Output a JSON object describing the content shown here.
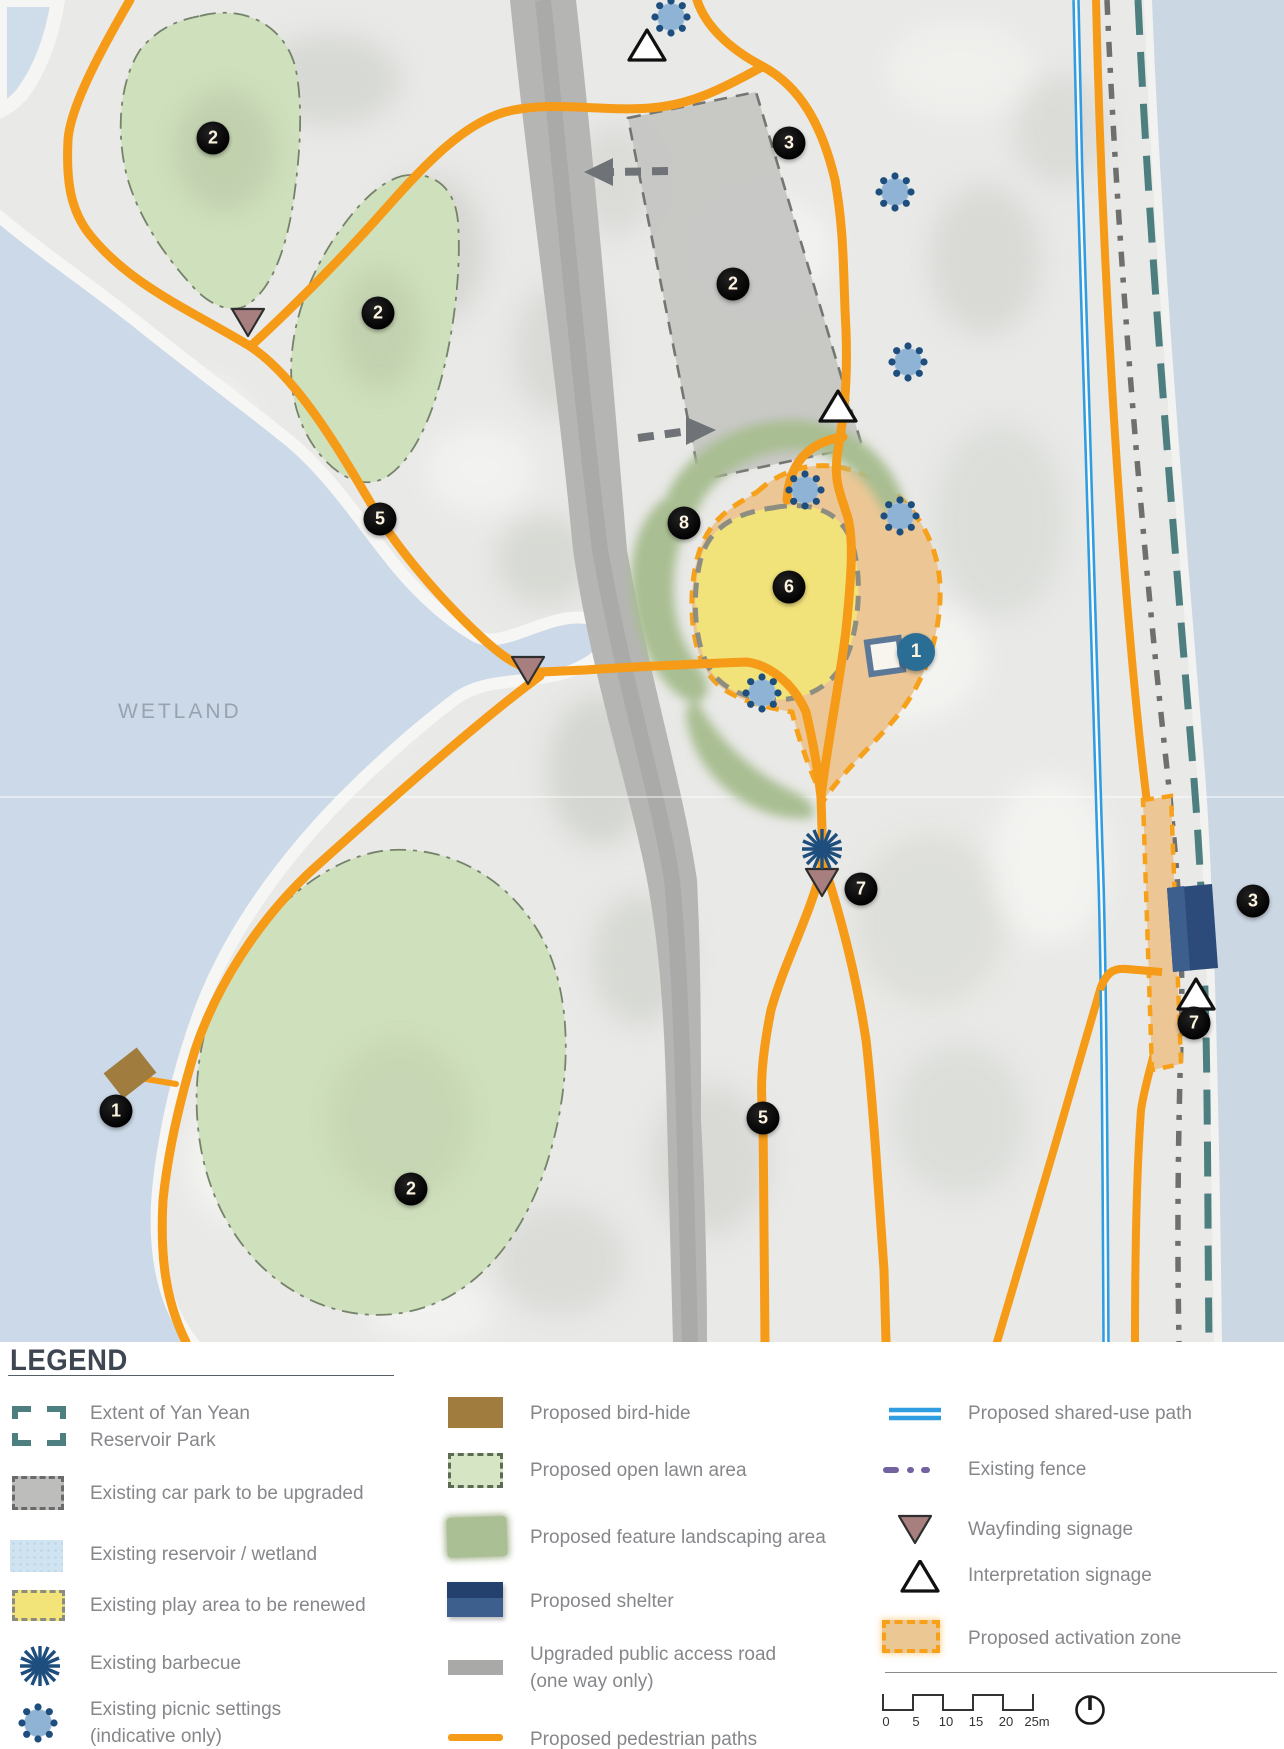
{
  "map": {
    "wetland_label": "WETLAND",
    "markers": [
      {
        "n": "2",
        "x": 213,
        "y": 138,
        "type": "black"
      },
      {
        "n": "2",
        "x": 378,
        "y": 313,
        "type": "black"
      },
      {
        "n": "3",
        "x": 789,
        "y": 143,
        "type": "black"
      },
      {
        "n": "2",
        "x": 733,
        "y": 284,
        "type": "black"
      },
      {
        "n": "5",
        "x": 380,
        "y": 519,
        "type": "black"
      },
      {
        "n": "8",
        "x": 684,
        "y": 523,
        "type": "black"
      },
      {
        "n": "6",
        "x": 789,
        "y": 587,
        "type": "black"
      },
      {
        "n": "1",
        "x": 916,
        "y": 652,
        "type": "teal"
      },
      {
        "n": "7",
        "x": 861,
        "y": 889,
        "type": "black"
      },
      {
        "n": "1",
        "x": 116,
        "y": 1111,
        "type": "black"
      },
      {
        "n": "5",
        "x": 763,
        "y": 1118,
        "type": "black"
      },
      {
        "n": "2",
        "x": 411,
        "y": 1189,
        "type": "black"
      },
      {
        "n": "3",
        "x": 1253,
        "y": 901,
        "type": "black"
      },
      {
        "n": "7",
        "x": 1194,
        "y": 1023,
        "type": "black"
      }
    ],
    "icons": [
      {
        "type": "picnic-settings-icon",
        "x": 671,
        "y": 17
      },
      {
        "type": "picnic-settings-icon",
        "x": 895,
        "y": 192
      },
      {
        "type": "picnic-settings-icon",
        "x": 908,
        "y": 362
      },
      {
        "type": "picnic-settings-icon",
        "x": 805,
        "y": 490
      },
      {
        "type": "picnic-settings-icon",
        "x": 900,
        "y": 516
      },
      {
        "type": "picnic-settings-icon",
        "x": 762,
        "y": 693
      },
      {
        "type": "interpretation-signage-icon",
        "x": 647,
        "y": 47
      },
      {
        "type": "interpretation-signage-icon",
        "x": 838,
        "y": 408
      },
      {
        "type": "interpretation-signage-icon",
        "x": 1196,
        "y": 996
      },
      {
        "type": "wayfinding-signage-icon",
        "x": 248,
        "y": 320
      },
      {
        "type": "wayfinding-signage-icon",
        "x": 528,
        "y": 668
      },
      {
        "type": "wayfinding-signage-icon",
        "x": 822,
        "y": 880
      },
      {
        "type": "barbecue-icon",
        "x": 822,
        "y": 849
      },
      {
        "type": "shelter-marker-icon",
        "x": 885,
        "y": 656
      }
    ]
  },
  "colors": {
    "path_orange": "#F59B18",
    "shared_use_blue": "#2F9DE0",
    "extent_teal": "#4D7F81",
    "activation_tan": "#ECC795",
    "play_yellow": "#F1E27A",
    "lawn_green": "#CFE0BD",
    "landscape_green": "#A9BE92",
    "wetland_blue": "#CCD9E8",
    "shelter_navy": "#2C4B7A",
    "birdhide_brown": "#A07C3E",
    "marker_black": "#111111",
    "marker_teal": "#2A6E96",
    "wayfinding_mauve": "#A77F7F",
    "fence_purple": "#7262A0"
  },
  "legend": {
    "title": "LEGEND",
    "items_left": [
      {
        "label": "Extent of Yan Yean",
        "label2": "Reservoir Park"
      },
      {
        "label": "Existing car park to be upgraded"
      },
      {
        "label": "Existing reservoir / wetland"
      },
      {
        "label": "Existing play area to be renewed"
      },
      {
        "label": "Existing barbecue"
      },
      {
        "label": "Existing picnic settings",
        "label2": "(indicative only)"
      }
    ],
    "items_middle": [
      {
        "label": "Proposed bird-hide"
      },
      {
        "label": "Proposed open lawn area"
      },
      {
        "label": "Proposed feature landscaping area"
      },
      {
        "label": "Proposed shelter"
      },
      {
        "label": "Upgraded public access road",
        "label2": "(one way only)"
      },
      {
        "label": "Proposed pedestrian paths"
      }
    ],
    "items_right": [
      {
        "label": "Proposed shared-use path"
      },
      {
        "label": "Existing fence"
      },
      {
        "label": "Wayfinding signage"
      },
      {
        "label": "Interpretation signage"
      },
      {
        "label": "Proposed activation zone"
      }
    ],
    "scale_labels": [
      "0",
      "5",
      "10",
      "15",
      "20",
      "25m"
    ]
  }
}
